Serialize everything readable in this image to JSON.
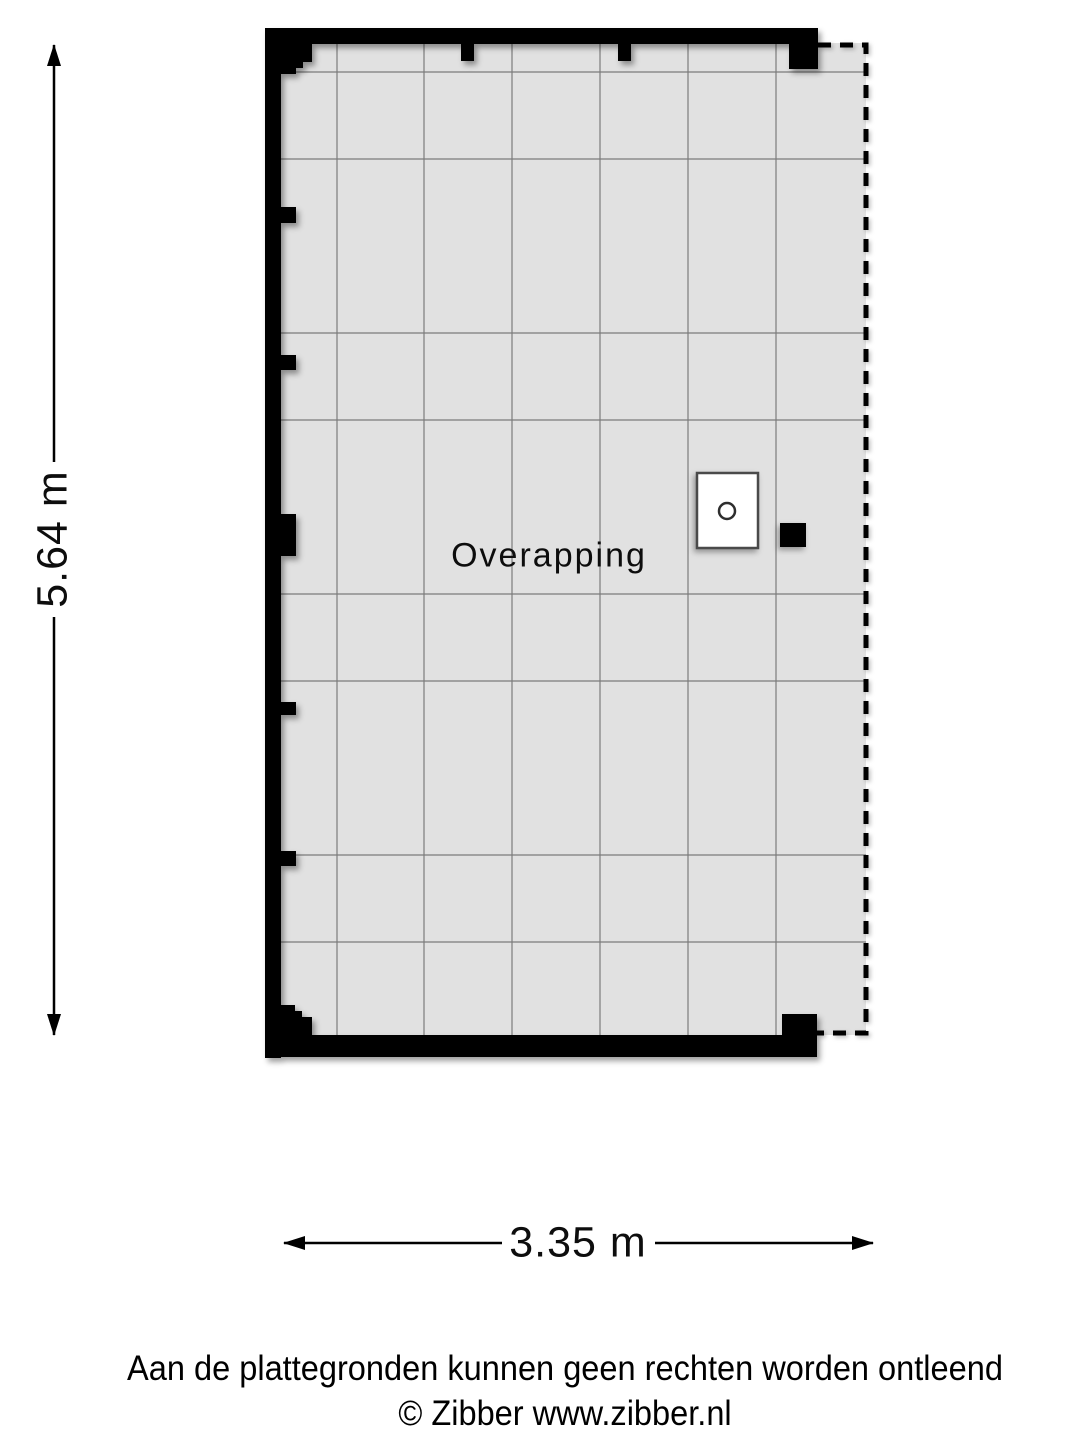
{
  "floorplan": {
    "room_label": "Overapping",
    "colors": {
      "floor_fill": "#e1e1e1",
      "grid_line": "#7b7b7b",
      "wall": "#000000"
    }
  },
  "dimensions": {
    "vertical": "5.64 m",
    "horizontal": "3.35 m"
  },
  "footer": {
    "disclaimer": "Aan de plattegronden kunnen geen rechten worden ontleend",
    "copyright": "© Zibber www.zibber.nl"
  }
}
